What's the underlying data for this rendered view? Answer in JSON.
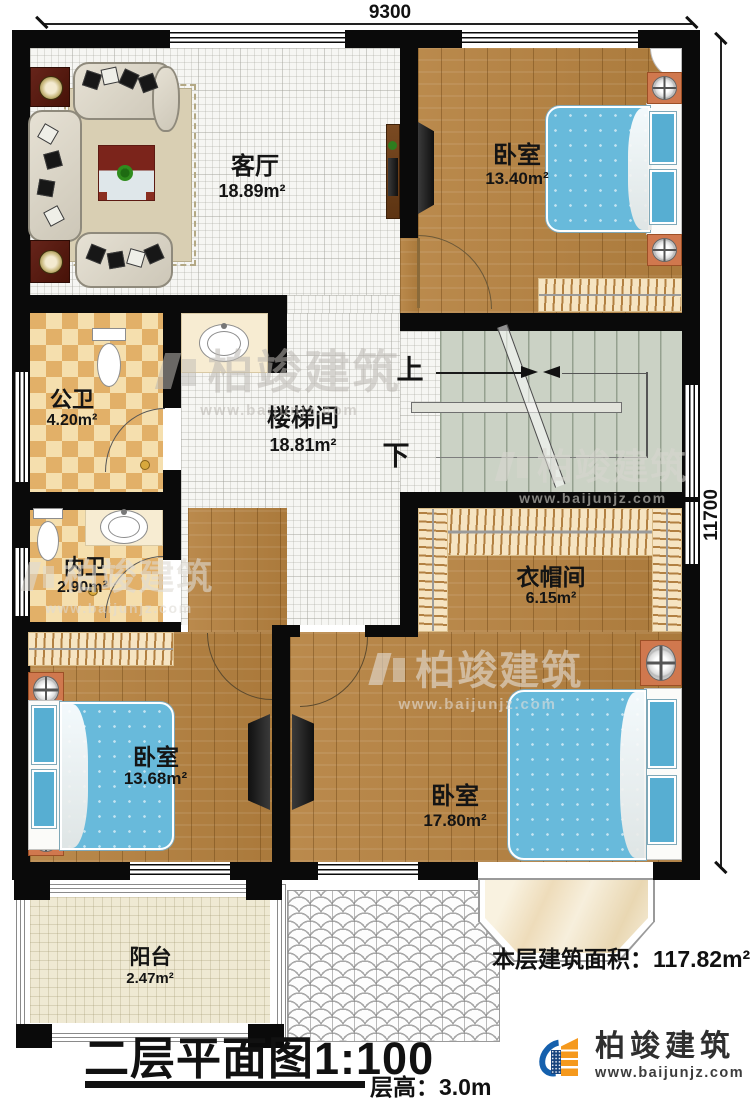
{
  "plan": {
    "dimensions": {
      "width_mm": "9300",
      "height_mm": "11700"
    },
    "rooms": {
      "living": {
        "name": "客厅",
        "area": "18.89m²"
      },
      "bedroom1": {
        "name": "卧室",
        "area": "13.40m²"
      },
      "public_bath": {
        "name": "公卫",
        "area": "4.20m²"
      },
      "stairwell": {
        "name": "楼梯间",
        "area": "18.81m²"
      },
      "private_bath": {
        "name": "内卫",
        "area": "2.90m²"
      },
      "cloakroom": {
        "name": "衣帽间",
        "area": "6.15m²"
      },
      "bedroom2": {
        "name": "卧室",
        "area": "13.68m²"
      },
      "bedroom3": {
        "name": "卧室",
        "area": "17.80m²"
      },
      "balcony": {
        "name": "阳台",
        "area": "2.47m²"
      }
    },
    "stairs": {
      "up": "上",
      "down": "下"
    }
  },
  "footer": {
    "area_label": "本层建筑面积：",
    "area_value": "117.82m²",
    "title": "二层平面图",
    "scale": "1:100",
    "height_label": "层高：",
    "height_value": "3.0m"
  },
  "brand": {
    "name": "柏竣建筑",
    "url": "www.baijunjz.com"
  },
  "colors": {
    "wall": "#0a0a0a",
    "wood_floor": "#b5813f",
    "tile_floor": "#f6f6f3",
    "checker_tile": "#e2b068",
    "stair_floor": "#cbd2c5",
    "bed": "#68badb",
    "nightstand": "#d0784e",
    "logo_blue": "#1560ad",
    "logo_orange": "#f5991d"
  }
}
